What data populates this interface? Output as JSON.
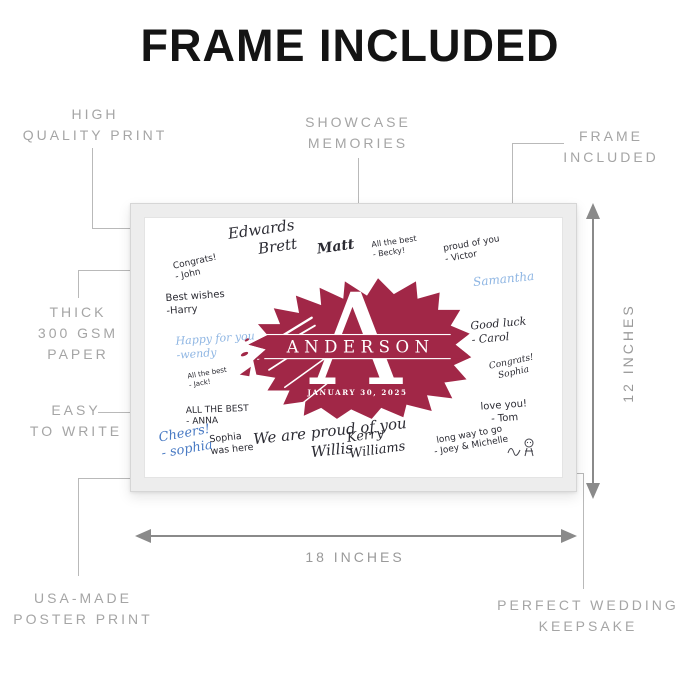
{
  "title": "FRAME INCLUDED",
  "callouts": {
    "high_quality_print": {
      "lines": [
        "HIGH",
        "QUALITY PRINT"
      ]
    },
    "showcase_memories": {
      "lines": [
        "SHOWCASE",
        "MEMORIES"
      ]
    },
    "frame_included": {
      "lines": [
        "FRAME",
        "INCLUDED"
      ]
    },
    "thick_paper": {
      "lines": [
        "THICK",
        "300 GSM",
        "PAPER"
      ]
    },
    "easy_to_write": {
      "lines": [
        "EASY",
        "TO WRITE"
      ]
    },
    "usa_made": {
      "lines": [
        "USA-MADE",
        "POSTER PRINT"
      ]
    },
    "wedding_keepsake": {
      "lines": [
        "PERFECT WEDDING",
        "KEEPSAKE"
      ]
    }
  },
  "dimensions": {
    "width_label": "18 INCHES",
    "height_label": "12 INCHES"
  },
  "poster": {
    "monogram_letter": "A",
    "family_name": "ANDERSON",
    "event_date": "JANUARY 30, 2025",
    "signatures": [
      {
        "id": "congrats-john",
        "text": "Congrats!\n- John"
      },
      {
        "id": "edwards-brett",
        "text": "Edwards\nBrett"
      },
      {
        "id": "matt",
        "text": "Matt"
      },
      {
        "id": "all-the-best-becky",
        "text": "All the best\n- Becky!"
      },
      {
        "id": "proud-of-you-victor",
        "text": "proud of you\n- Victor"
      },
      {
        "id": "samantha",
        "text": "Samantha"
      },
      {
        "id": "best-wishes-harry",
        "text": "Best wishes\n-Harry"
      },
      {
        "id": "happy-for-you-wendy",
        "text": "Happy for you\n-wendy"
      },
      {
        "id": "all-the-best-jack",
        "text": "All the best\n- Jack!"
      },
      {
        "id": "all-the-best-anna",
        "text": "ALL THE BEST\n- ANNA"
      },
      {
        "id": "cheers-sophia",
        "text": "Cheers!\n- sophia"
      },
      {
        "id": "sophia-was-here",
        "text": "Sophia\nwas here"
      },
      {
        "id": "we-are-proud",
        "text": "We are proud of you\nWillis"
      },
      {
        "id": "kerry-williams",
        "text": "Kerry\nWilliams"
      },
      {
        "id": "good-luck-carol",
        "text": "Good luck\n- Carol"
      },
      {
        "id": "congrats-sophia",
        "text": "Congrats!\nSophia"
      },
      {
        "id": "love-you-tom",
        "text": "love you!\n- Tom"
      },
      {
        "id": "long-way-to-go",
        "text": "long way to go\n- Joey & Michelle"
      }
    ]
  },
  "colors": {
    "splash_red": "#a12747",
    "frame_gray": "#ededed",
    "label_gray": "#a5a5a5",
    "arrow_gray": "#8a8a8a",
    "ink_dark": "#2b2b33",
    "ink_blue": "#4a7bc4",
    "ink_light_blue": "#8fb6e3"
  }
}
